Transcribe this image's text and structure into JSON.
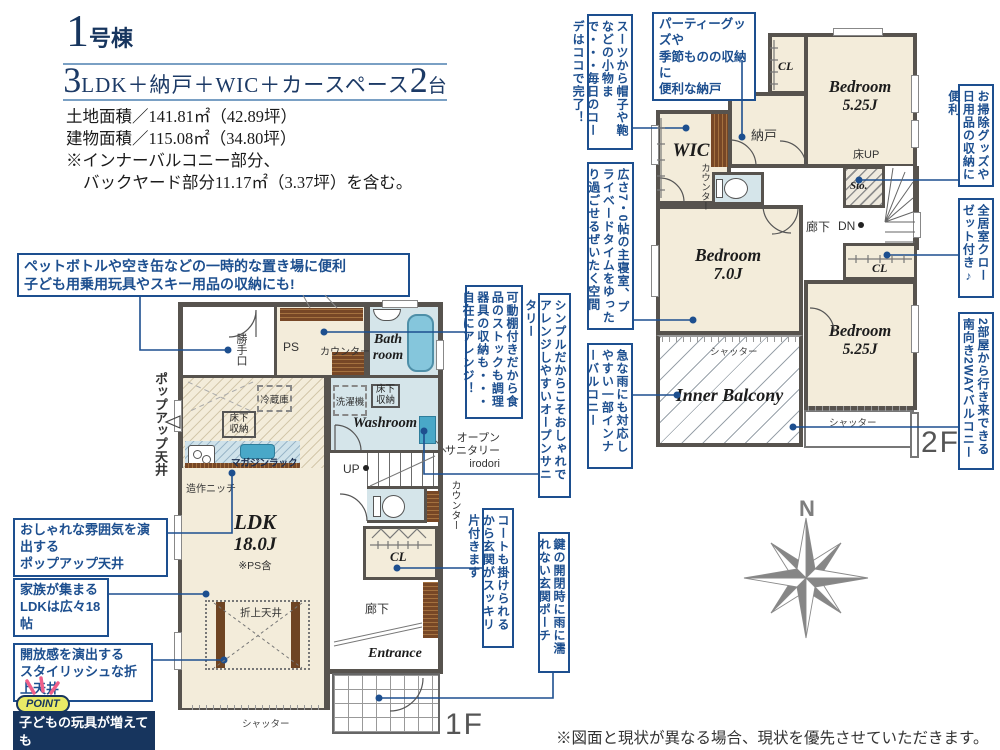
{
  "header": {
    "building_number": "1",
    "building_unit": "号棟",
    "spec_big1": "3",
    "spec_text": "LDK＋納戸＋WIC＋カースペース",
    "spec_big2": "2",
    "spec_unit": "台",
    "area_lines": [
      "土地面積／141.81㎡（42.89坪）",
      "建物面積／115.08㎡（34.80坪）",
      "※インナーバルコニー部分、",
      "バックヤード部分11.17㎡（3.37坪）を含む。"
    ]
  },
  "floor1": {
    "floor_label": "1F",
    "labels": {
      "katteguchi": "勝手口",
      "ps": "PS",
      "kadoudana": "可動棚4段",
      "counter": "カウンター",
      "bath": "Bath\nroom",
      "reizouko": "冷蔵庫",
      "yukashita": "床下\n収納",
      "sentakuki": "洗濯機",
      "washroom": "Washroom",
      "magazine": "マガジンラック",
      "niche": "造作ニッチ",
      "up": "UP",
      "open_sanitary": "オープン\nサニタリー\nirodori",
      "ldk": "LDK",
      "ldk_size": "18.0J",
      "ldk_note": "※PS含",
      "cl": "CL",
      "rouka": "廊下",
      "oriage": "折上天井",
      "entrance": "Entrance",
      "shutter": "シャッター",
      "popup": "ポップアップ天井"
    }
  },
  "floor2": {
    "floor_label": "2F",
    "labels": {
      "wic": "WIC",
      "counter": "カウンター",
      "nando": "納戸",
      "cl": "CL",
      "bedA_name": "Bedroom",
      "bedA_size": "5.25J",
      "yuka_up": "床UP",
      "sto": "Sto.",
      "rouka": "廊下",
      "dn": "DN",
      "bedB_name": "Bedroom",
      "bedB_size": "7.0J",
      "bedC_name": "Bedroom",
      "bedC_size": "5.25J",
      "inner_balcony": "Inner Balcony",
      "shutter": "シャッター"
    }
  },
  "callouts": {
    "pet_bottle": "ペットボトルや空き缶などの一時的な置き場に便利\n子ども用乗用玩具やスキー用品の収納にも!",
    "oshare": "おしゃれな雰囲気を演出する\nポップアップ天井",
    "kazoku": "家族が集まる\nLDKは広々18帖",
    "kaihou": "開放感を演出する\nスタイリッシュな折上天井",
    "point_label": "POINT",
    "point_text": "子どもの玩具が増えても\n安心の収納力です",
    "kadoudana": "可動棚付きだから食品のストックも調理器具の収納も・・・自在にアレンジ！",
    "simple_sanitary": "シンプルだからこそおしゃれでアレンジしやすいオープンサニタリー",
    "coat": "コートも掛けられるから玄関がスッキリ片付きます",
    "kagi": "鍵の開閉時に雨に濡れない玄関ポーチ",
    "suits": "スーツから帽子や鞄などの小物まで・・・毎日のコーデはココで完了！",
    "party": "パーティーグッズや\n季節ものの収納に\n便利な納戸",
    "shushin": "広さ7・0帖の主寝室、プライベードタイムをゆったり過ごせるぜいたく空間",
    "kyuna": "急な雨にも対応しやすい一部インナーバルコニー",
    "osouji": "お掃除グッズや日用品の収納に便利",
    "zenkyo": "全居室クローゼット付き♪",
    "two_way": "2部屋から行き来できる南向き2WAYバルコニー"
  },
  "compass": {
    "north": "N"
  },
  "footer": {
    "disclaimer": "※図面と現状が異なる場合、現状を優先させていただきます。"
  },
  "colors": {
    "accent_navy": "#1d4f8f",
    "wall_gray": "#57534e",
    "floor_cream": "#f3ecda",
    "wet_blue": "#d5e5ea",
    "tub_blue": "#85c6dc",
    "wood_brown": "#774726",
    "point_yellow": "#e9ea66",
    "navy_box": "#17355e"
  }
}
